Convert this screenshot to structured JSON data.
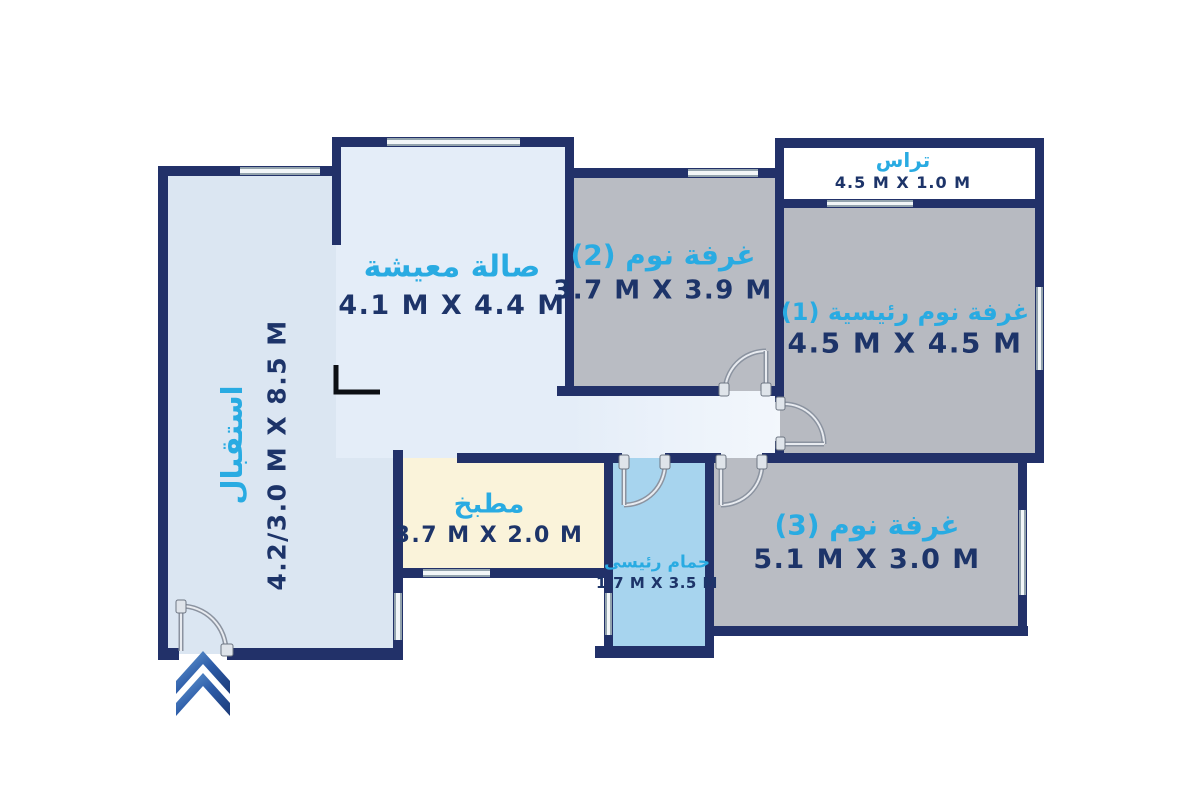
{
  "page": {
    "type": "apartment-floor-plan"
  },
  "rooms": {
    "reception": {
      "name": "استقبال",
      "dims": "4.2/3.0 M X 8.5 M"
    },
    "living_room": {
      "name": "صالة معيشة",
      "dims": "4.1 M X 4.4 M"
    },
    "bedroom_2": {
      "name": "غرفة نوم (2)",
      "dims": "3.7 M X 3.9 M"
    },
    "terrace": {
      "name": "تراس",
      "dims": "4.5 M X 1.0 M"
    },
    "master_bedroom": {
      "name": "غرفة نوم رئيسية (1)",
      "dims": "4.5 M X 4.5 M"
    },
    "kitchen": {
      "name": "مطبخ",
      "dims": "3.7 M X 2.0 M"
    },
    "master_bathroom": {
      "name": "حمام رئيسى",
      "dims": "1.7 M X 3.5 M"
    },
    "bedroom_3": {
      "name": "غرفة نوم (3)",
      "dims": "5.1 M X 3.0 M"
    }
  },
  "colors": {
    "wall": "#223169",
    "room_label": "#29abe2",
    "dimension_text": "#1d3469",
    "bedroom_fill": "#b9bcc3",
    "reception_fill": "#dbe6f2",
    "living_fill": "#e4edf8",
    "corridor_fill": "#eff4fb",
    "kitchen_fill": "#faf3da",
    "bathroom_fill": "#a7d4ee",
    "terrace_fill": "#ffffff",
    "entrance_arrow": "#2d5ca8"
  }
}
